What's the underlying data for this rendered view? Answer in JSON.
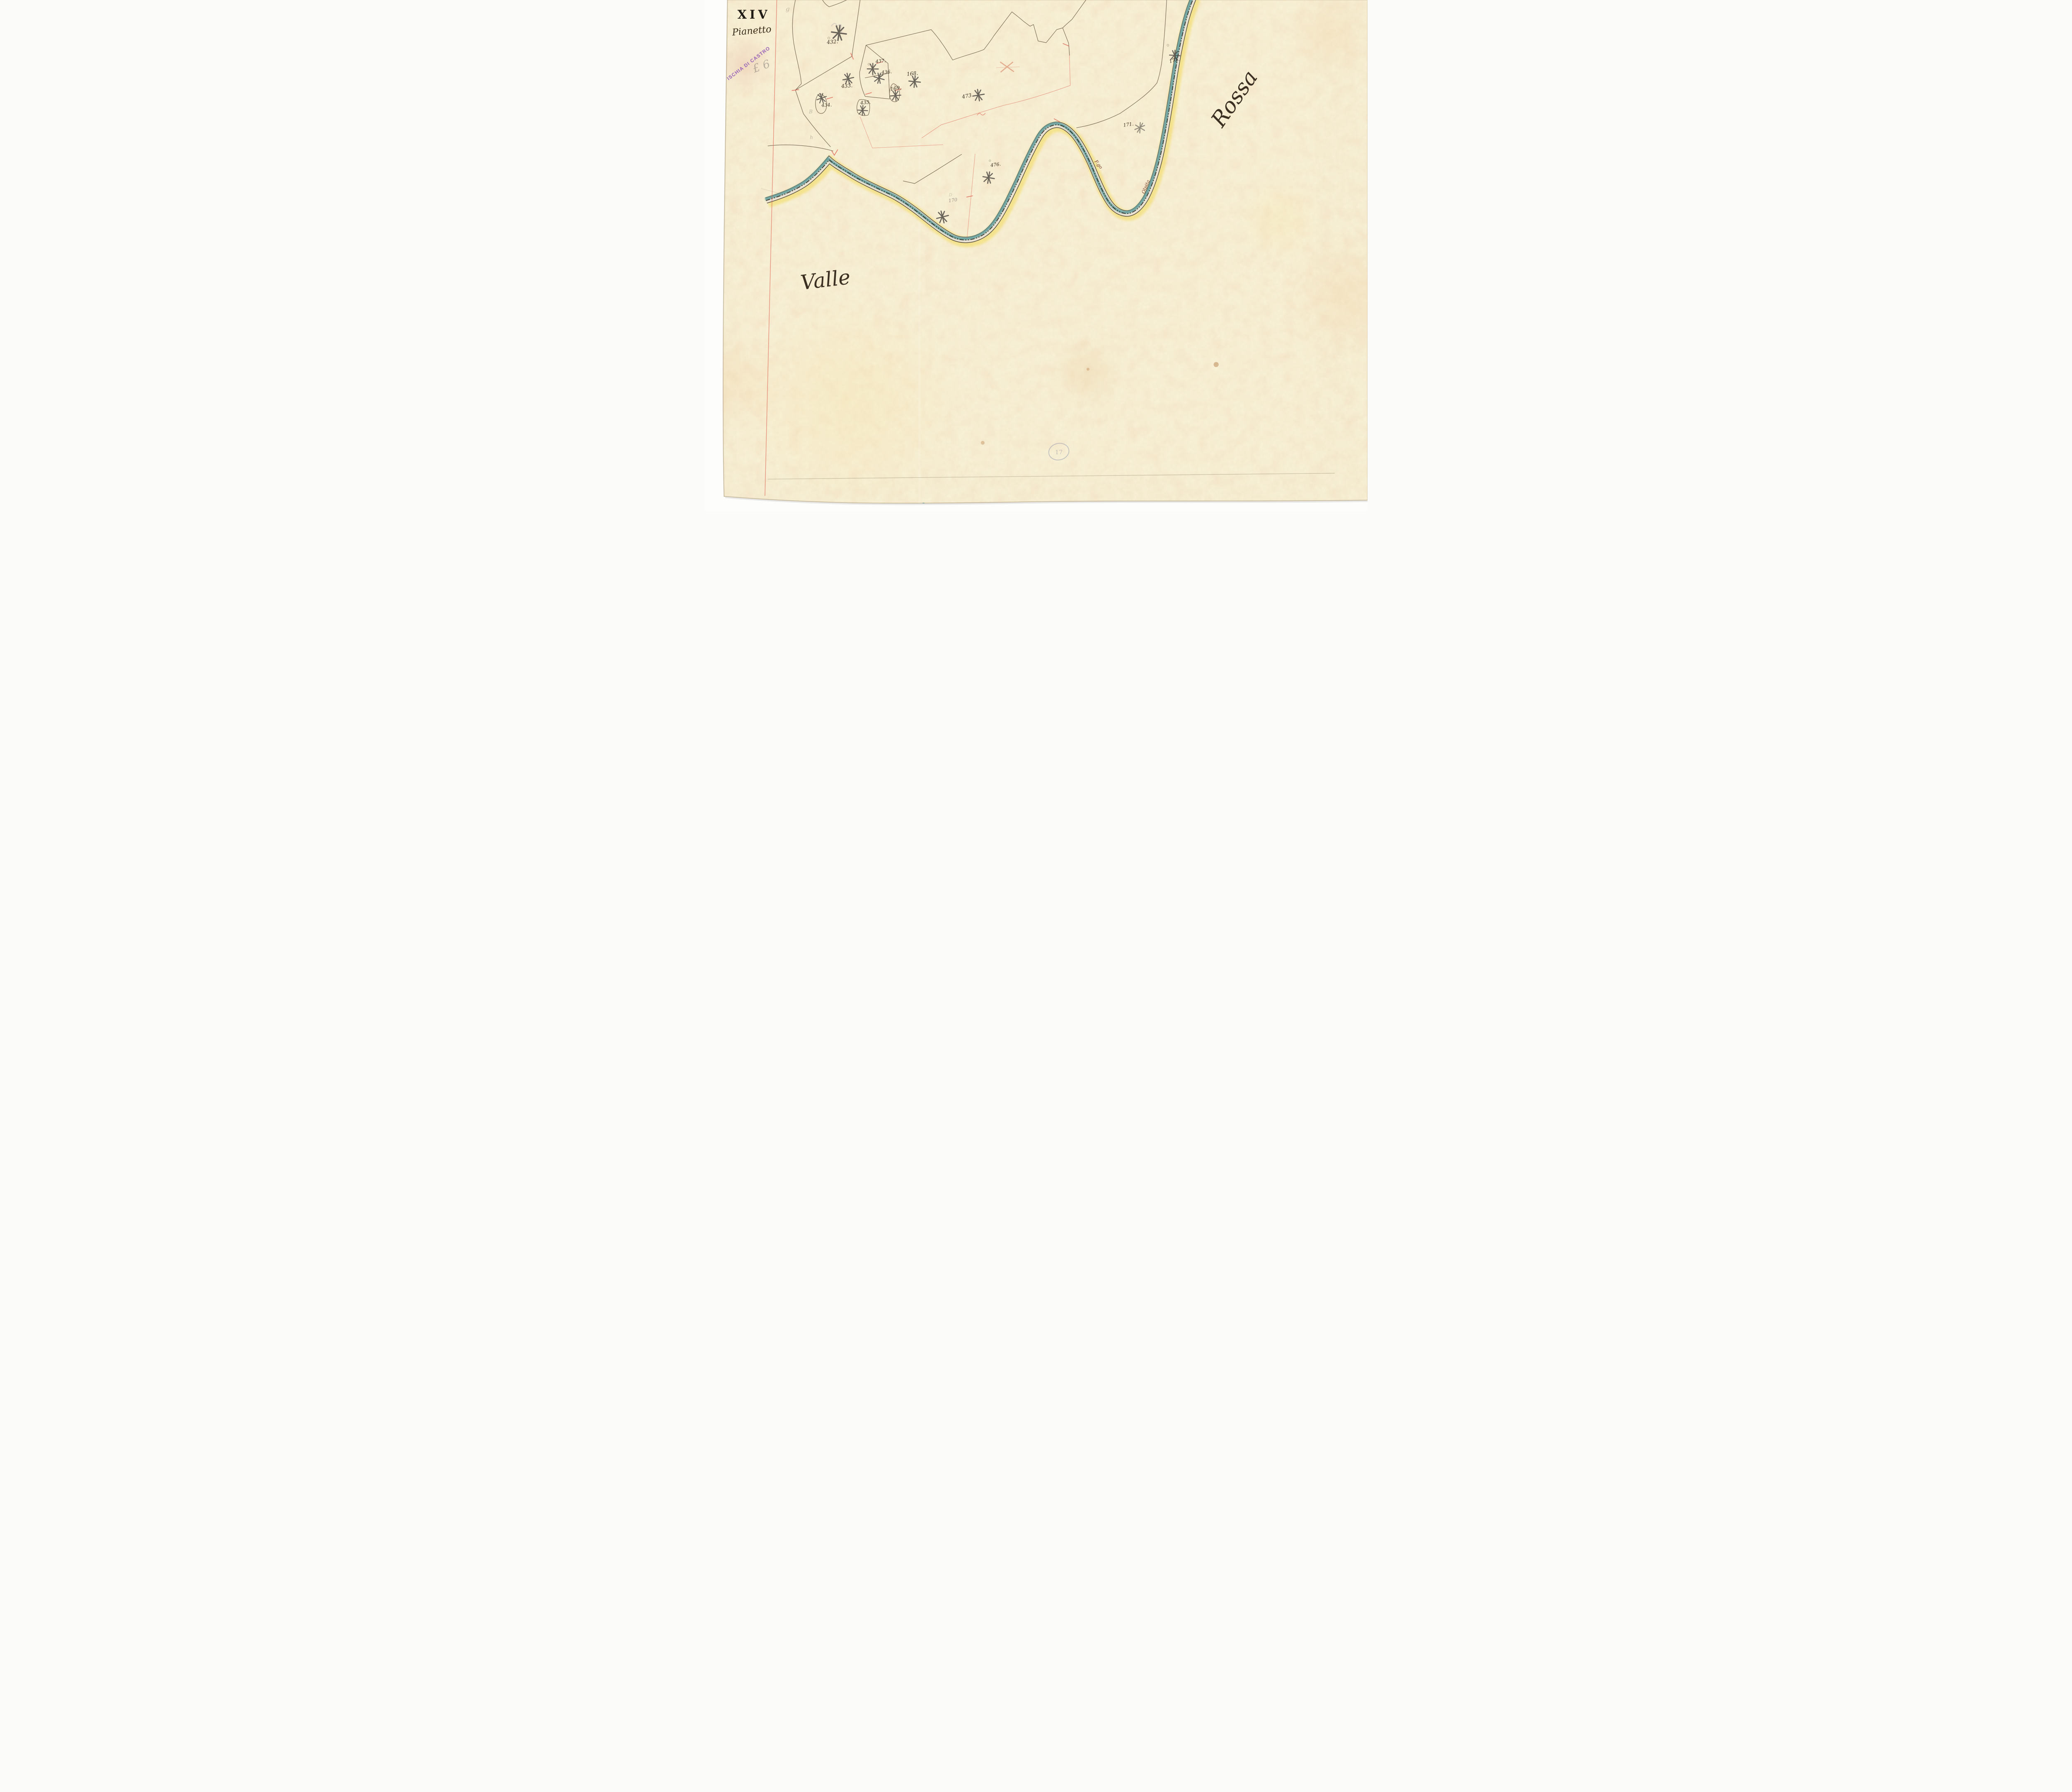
{
  "document": {
    "plate_number": "XIV",
    "section_name": "Pianetto",
    "toponym_left": "Valle",
    "toponym_right": "Rossa",
    "municipality_stamp": "ISCHIA DI CASTRO",
    "embossed_stamp_text": "17",
    "pencil_note": "£ 6",
    "pencil_marks": {
      "top": "g",
      "left_b": "B",
      "left_h": "h",
      "small_d": "D"
    }
  },
  "roads": {
    "label_west": "F.go",
    "label_east": "Olpita"
  },
  "parcels": [
    {
      "label": "432."
    },
    {
      "label": "433."
    },
    {
      "label": "434."
    },
    {
      "label": "435."
    },
    {
      "label": "436."
    },
    {
      "label": "437."
    },
    {
      "label": "168."
    },
    {
      "label": "169,"
    },
    {
      "label": "170"
    },
    {
      "label": "171."
    },
    {
      "label": "172."
    },
    {
      "label": "473"
    },
    {
      "label": "476."
    }
  ],
  "colors": {
    "paper": "#f8f1d6",
    "road_surface": "#ebe2d2",
    "road_water_teal": "#4f9494",
    "road_outer_yellow": "#f2d84b",
    "boundary_ink": "#5a4937",
    "survey_red": "#dd5f50",
    "stamp_purple": "#8a50b5",
    "handwriting_ink": "#3a2f20",
    "pencil_gray": "#7d776e",
    "tree_graphite": "#4f4a44"
  }
}
